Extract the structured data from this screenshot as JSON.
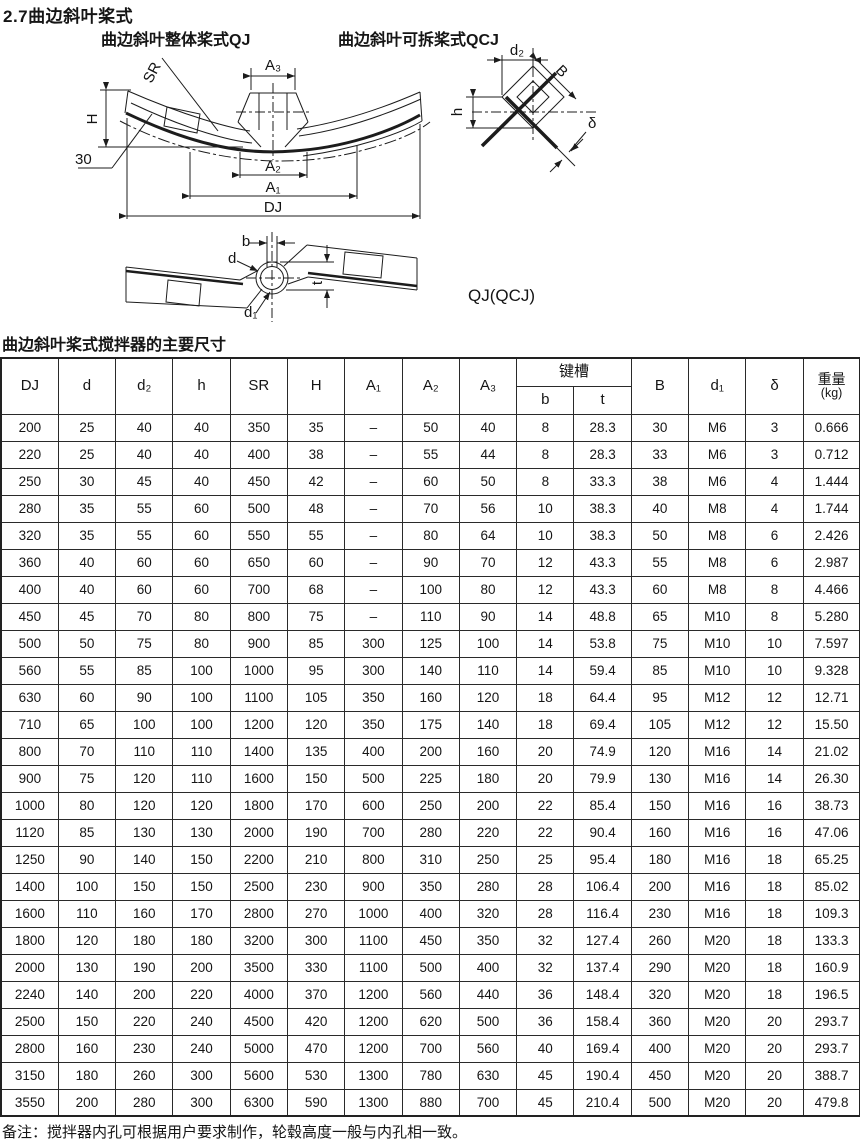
{
  "page": {
    "title": "2.7曲边斜叶桨式",
    "note": "备注：搅拌器内孔可根据用户要求制作，轮毂高度一般与内孔相一致。"
  },
  "figure": {
    "label_qj": "曲边斜叶整体桨式QJ",
    "label_qcj": "曲边斜叶可拆桨式QCJ",
    "model_label": "QJ(QCJ)",
    "dim_sr": "SR",
    "dim_a3": "A₃",
    "dim_h_upper": "H",
    "dim_angle": "30",
    "dim_a2": "A₂",
    "dim_a1": "A₁",
    "dim_dj": "DJ",
    "dim_d2": "d₂",
    "dim_b_upper": "B",
    "dim_h_lower": "h",
    "dim_delta": "δ",
    "dim_b": "b",
    "dim_d": "d",
    "dim_t": "t",
    "dim_d1": "d₁"
  },
  "table": {
    "caption": "曲边斜叶桨式搅拌器的主要尺寸",
    "headers": {
      "dj": "DJ",
      "d": "d",
      "d2": "d₂",
      "h": "h",
      "sr": "SR",
      "hcap": "H",
      "a1": "A₁",
      "a2": "A₂",
      "a3": "A₃",
      "keyway": "键槽",
      "b": "b",
      "t": "t",
      "bcap": "B",
      "d1": "d₁",
      "delta": "δ",
      "weight": "重量",
      "weight_unit": "(kg)"
    },
    "rows": [
      [
        "200",
        "25",
        "40",
        "40",
        "350",
        "35",
        "–",
        "50",
        "40",
        "8",
        "28.3",
        "30",
        "M6",
        "3",
        "0.666"
      ],
      [
        "220",
        "25",
        "40",
        "40",
        "400",
        "38",
        "–",
        "55",
        "44",
        "8",
        "28.3",
        "33",
        "M6",
        "3",
        "0.712"
      ],
      [
        "250",
        "30",
        "45",
        "40",
        "450",
        "42",
        "–",
        "60",
        "50",
        "8",
        "33.3",
        "38",
        "M6",
        "4",
        "1.444"
      ],
      [
        "280",
        "35",
        "55",
        "60",
        "500",
        "48",
        "–",
        "70",
        "56",
        "10",
        "38.3",
        "40",
        "M8",
        "4",
        "1.744"
      ],
      [
        "320",
        "35",
        "55",
        "60",
        "550",
        "55",
        "–",
        "80",
        "64",
        "10",
        "38.3",
        "50",
        "M8",
        "6",
        "2.426"
      ],
      [
        "360",
        "40",
        "60",
        "60",
        "650",
        "60",
        "–",
        "90",
        "70",
        "12",
        "43.3",
        "55",
        "M8",
        "6",
        "2.987"
      ],
      [
        "400",
        "40",
        "60",
        "60",
        "700",
        "68",
        "–",
        "100",
        "80",
        "12",
        "43.3",
        "60",
        "M8",
        "8",
        "4.466"
      ],
      [
        "450",
        "45",
        "70",
        "80",
        "800",
        "75",
        "–",
        "110",
        "90",
        "14",
        "48.8",
        "65",
        "M10",
        "8",
        "5.280"
      ],
      [
        "500",
        "50",
        "75",
        "80",
        "900",
        "85",
        "300",
        "125",
        "100",
        "14",
        "53.8",
        "75",
        "M10",
        "10",
        "7.597"
      ],
      [
        "560",
        "55",
        "85",
        "100",
        "1000",
        "95",
        "300",
        "140",
        "110",
        "14",
        "59.4",
        "85",
        "M10",
        "10",
        "9.328"
      ],
      [
        "630",
        "60",
        "90",
        "100",
        "1100",
        "105",
        "350",
        "160",
        "120",
        "18",
        "64.4",
        "95",
        "M12",
        "12",
        "12.71"
      ],
      [
        "710",
        "65",
        "100",
        "100",
        "1200",
        "120",
        "350",
        "175",
        "140",
        "18",
        "69.4",
        "105",
        "M12",
        "12",
        "15.50"
      ],
      [
        "800",
        "70",
        "110",
        "110",
        "1400",
        "135",
        "400",
        "200",
        "160",
        "20",
        "74.9",
        "120",
        "M16",
        "14",
        "21.02"
      ],
      [
        "900",
        "75",
        "120",
        "110",
        "1600",
        "150",
        "500",
        "225",
        "180",
        "20",
        "79.9",
        "130",
        "M16",
        "14",
        "26.30"
      ],
      [
        "1000",
        "80",
        "120",
        "120",
        "1800",
        "170",
        "600",
        "250",
        "200",
        "22",
        "85.4",
        "150",
        "M16",
        "16",
        "38.73"
      ],
      [
        "1120",
        "85",
        "130",
        "130",
        "2000",
        "190",
        "700",
        "280",
        "220",
        "22",
        "90.4",
        "160",
        "M16",
        "16",
        "47.06"
      ],
      [
        "1250",
        "90",
        "140",
        "150",
        "2200",
        "210",
        "800",
        "310",
        "250",
        "25",
        "95.4",
        "180",
        "M16",
        "18",
        "65.25"
      ],
      [
        "1400",
        "100",
        "150",
        "150",
        "2500",
        "230",
        "900",
        "350",
        "280",
        "28",
        "106.4",
        "200",
        "M16",
        "18",
        "85.02"
      ],
      [
        "1600",
        "110",
        "160",
        "170",
        "2800",
        "270",
        "1000",
        "400",
        "320",
        "28",
        "116.4",
        "230",
        "M16",
        "18",
        "109.3"
      ],
      [
        "1800",
        "120",
        "180",
        "180",
        "3200",
        "300",
        "1100",
        "450",
        "350",
        "32",
        "127.4",
        "260",
        "M20",
        "18",
        "133.3"
      ],
      [
        "2000",
        "130",
        "190",
        "200",
        "3500",
        "330",
        "1100",
        "500",
        "400",
        "32",
        "137.4",
        "290",
        "M20",
        "18",
        "160.9"
      ],
      [
        "2240",
        "140",
        "200",
        "220",
        "4000",
        "370",
        "1200",
        "560",
        "440",
        "36",
        "148.4",
        "320",
        "M20",
        "18",
        "196.5"
      ],
      [
        "2500",
        "150",
        "220",
        "240",
        "4500",
        "420",
        "1200",
        "620",
        "500",
        "36",
        "158.4",
        "360",
        "M20",
        "20",
        "293.7"
      ],
      [
        "2800",
        "160",
        "230",
        "240",
        "5000",
        "470",
        "1200",
        "700",
        "560",
        "40",
        "169.4",
        "400",
        "M20",
        "20",
        "293.7"
      ],
      [
        "3150",
        "180",
        "260",
        "300",
        "5600",
        "530",
        "1300",
        "780",
        "630",
        "45",
        "190.4",
        "450",
        "M20",
        "20",
        "388.7"
      ],
      [
        "3550",
        "200",
        "280",
        "300",
        "6300",
        "590",
        "1300",
        "880",
        "700",
        "45",
        "210.4",
        "500",
        "M20",
        "20",
        "479.8"
      ]
    ]
  }
}
